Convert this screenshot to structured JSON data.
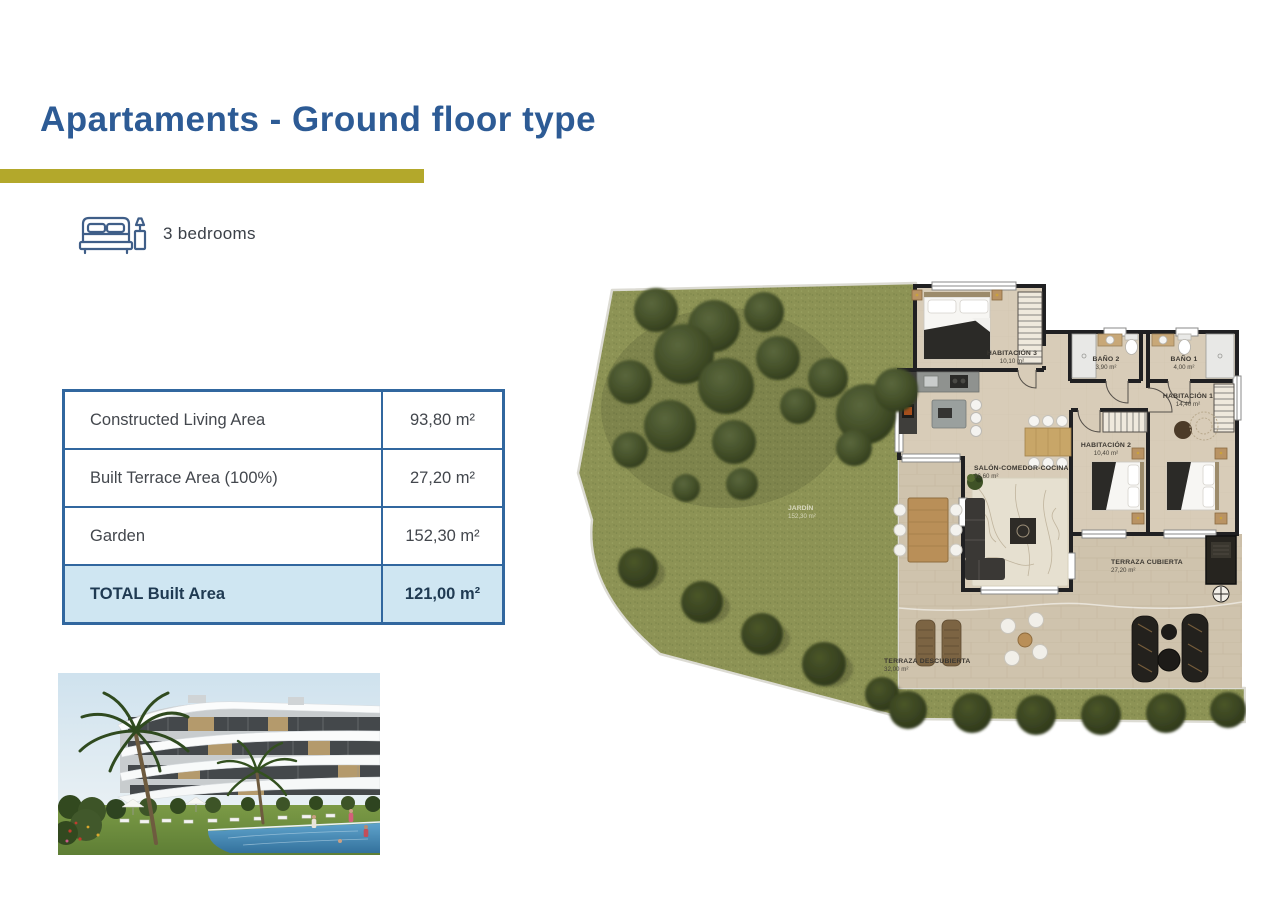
{
  "header": {
    "title": "Apartaments - Ground floor type",
    "bedrooms_label": "3 bedrooms"
  },
  "area_table": {
    "rows": [
      {
        "label": "Constructed Living Area",
        "value": "93,80 m²"
      },
      {
        "label": "Built Terrace Area (100%)",
        "value": "27,20 m²"
      },
      {
        "label": "Garden",
        "value": "152,30 m²"
      },
      {
        "label": "TOTAL Built Area",
        "value": "121,00 m²"
      }
    ]
  },
  "floor_plan": {
    "garden": {
      "name": "JARDÍN",
      "area": "152,30 m²"
    },
    "rooms": [
      {
        "name": "HABITACIÓN 3",
        "area": "10,10 m²"
      },
      {
        "name": "BAÑO 2",
        "area": "3,90 m²"
      },
      {
        "name": "BAÑO 1",
        "area": "4,00 m²"
      },
      {
        "name": "HABITACIÓN 1",
        "area": "14,40 m²"
      },
      {
        "name": "HABITACIÓN 2",
        "area": "10,40 m²"
      },
      {
        "name": "SALÓN-COMEDOR-COCINA",
        "area": "36,60 m²"
      },
      {
        "name": "TERRAZA CUBIERTA",
        "area": "27,20 m²"
      },
      {
        "name": "TERRAZA DESCUBIERTA",
        "area": "32,00 m²"
      }
    ]
  },
  "colors": {
    "title_blue": "#2d5b95",
    "accent_olive": "#b3a82b",
    "table_border": "#31679f",
    "total_row_bg": "#cfe6f2",
    "grass_green": "#8d9355",
    "floor_beige": "#d8ccb8",
    "terrace_beige": "#cfc3ad",
    "wall_dark": "#202022"
  }
}
